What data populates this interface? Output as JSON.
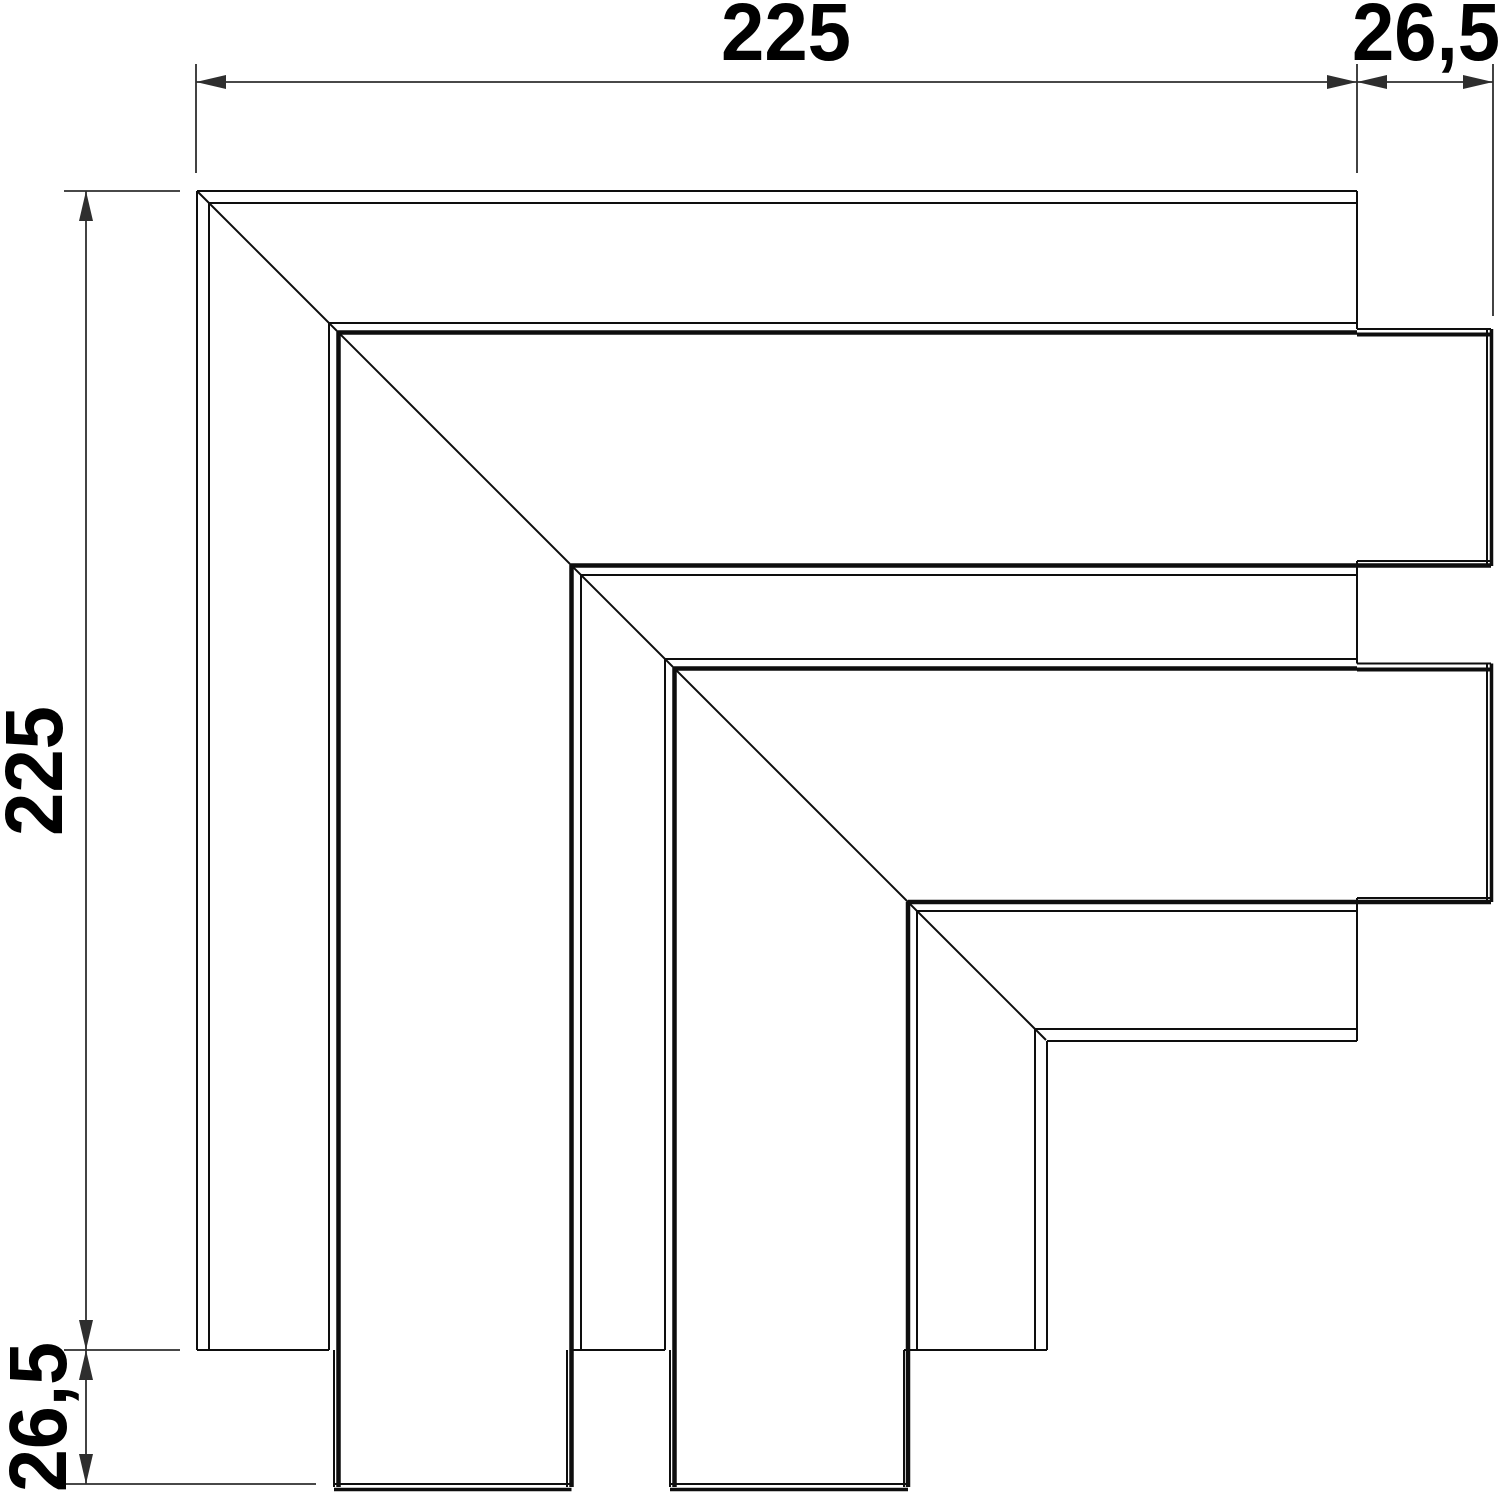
{
  "title": "Corner piece technical drawing",
  "canvas": {
    "width": 1500,
    "height": 1495,
    "background": "#ffffff",
    "line_color": "#0e0e0e",
    "dim_color": "#2e2e2e",
    "text_color": "#000000",
    "font_size": 82
  },
  "dimensions": {
    "top_width": {
      "label": "225"
    },
    "top_tail": {
      "label": "26,5"
    },
    "left_height": {
      "label": "225"
    },
    "bottom_tail": {
      "label": "26,5"
    }
  },
  "drawing": {
    "segments": [
      {
        "x1": 197,
        "y1": 191,
        "x2": 1046,
        "y2": 1040,
        "w": 2
      },
      {
        "x1": 197,
        "y1": 191,
        "x2": 1357,
        "y2": 191,
        "w": 2
      },
      {
        "x1": 209,
        "y1": 203,
        "x2": 1357,
        "y2": 203,
        "w": 2
      },
      {
        "x1": 329,
        "y1": 323,
        "x2": 1357,
        "y2": 323,
        "w": 2
      },
      {
        "x1": 338,
        "y1": 332.5,
        "x2": 1357,
        "y2": 332.5,
        "w": 4.5
      },
      {
        "x1": 1357,
        "y1": 329,
        "x2": 1491,
        "y2": 329,
        "w": 2
      },
      {
        "x1": 1357,
        "y1": 334.5,
        "x2": 1491,
        "y2": 334.5,
        "w": 4
      },
      {
        "x1": 1357,
        "y1": 561,
        "x2": 1491,
        "y2": 561,
        "w": 2
      },
      {
        "x1": 571,
        "y1": 565.5,
        "x2": 1491,
        "y2": 565.5,
        "w": 4.5
      },
      {
        "x1": 581,
        "y1": 575,
        "x2": 1357,
        "y2": 575,
        "w": 2
      },
      {
        "x1": 665,
        "y1": 659,
        "x2": 1357,
        "y2": 659,
        "w": 2
      },
      {
        "x1": 674,
        "y1": 668.5,
        "x2": 1357,
        "y2": 668.5,
        "w": 4.5
      },
      {
        "x1": 1357,
        "y1": 663.5,
        "x2": 1491,
        "y2": 663.5,
        "w": 2
      },
      {
        "x1": 1357,
        "y1": 669.5,
        "x2": 1491,
        "y2": 669.5,
        "w": 4
      },
      {
        "x1": 1357,
        "y1": 898,
        "x2": 1491,
        "y2": 898,
        "w": 2
      },
      {
        "x1": 908,
        "y1": 902,
        "x2": 1491,
        "y2": 902,
        "w": 4.5
      },
      {
        "x1": 917,
        "y1": 911,
        "x2": 1357,
        "y2": 911,
        "w": 2
      },
      {
        "x1": 1035,
        "y1": 1029,
        "x2": 1357,
        "y2": 1029,
        "w": 2
      },
      {
        "x1": 1047,
        "y1": 1041,
        "x2": 1357,
        "y2": 1041,
        "w": 2
      },
      {
        "x1": 197,
        "y1": 191,
        "x2": 197,
        "y2": 1350,
        "w": 2
      },
      {
        "x1": 209,
        "y1": 203,
        "x2": 209,
        "y2": 1350,
        "w": 2
      },
      {
        "x1": 329,
        "y1": 323,
        "x2": 329,
        "y2": 1350,
        "w": 2
      },
      {
        "x1": 338.5,
        "y1": 332,
        "x2": 338.5,
        "y2": 1487,
        "w": 4.5
      },
      {
        "x1": 334,
        "y1": 1350,
        "x2": 334,
        "y2": 1487,
        "w": 2
      },
      {
        "x1": 571.5,
        "y1": 565,
        "x2": 571.5,
        "y2": 1487,
        "w": 4.5
      },
      {
        "x1": 567,
        "y1": 1350,
        "x2": 567,
        "y2": 1487,
        "w": 2
      },
      {
        "x1": 581,
        "y1": 575,
        "x2": 581,
        "y2": 1350,
        "w": 2
      },
      {
        "x1": 665,
        "y1": 659,
        "x2": 665,
        "y2": 1350,
        "w": 2
      },
      {
        "x1": 674.5,
        "y1": 668,
        "x2": 674.5,
        "y2": 1487,
        "w": 4.5
      },
      {
        "x1": 670,
        "y1": 1350,
        "x2": 670,
        "y2": 1487,
        "w": 2
      },
      {
        "x1": 904,
        "y1": 1350,
        "x2": 904,
        "y2": 1487,
        "w": 2
      },
      {
        "x1": 908,
        "y1": 902,
        "x2": 908,
        "y2": 1487,
        "w": 4.5
      },
      {
        "x1": 917,
        "y1": 911,
        "x2": 917,
        "y2": 1350,
        "w": 2
      },
      {
        "x1": 1035,
        "y1": 1029,
        "x2": 1035,
        "y2": 1350,
        "w": 2
      },
      {
        "x1": 1047,
        "y1": 1041,
        "x2": 1047,
        "y2": 1350,
        "w": 2
      },
      {
        "x1": 1357,
        "y1": 191,
        "x2": 1357,
        "y2": 329,
        "w": 2
      },
      {
        "x1": 1357,
        "y1": 561,
        "x2": 1357,
        "y2": 663.5,
        "w": 2
      },
      {
        "x1": 1357,
        "y1": 898,
        "x2": 1357,
        "y2": 1041,
        "w": 2
      },
      {
        "x1": 1487,
        "y1": 329,
        "x2": 1487,
        "y2": 566,
        "w": 2
      },
      {
        "x1": 1491.5,
        "y1": 329,
        "x2": 1491.5,
        "y2": 566,
        "w": 3.5
      },
      {
        "x1": 1487,
        "y1": 663.5,
        "x2": 1487,
        "y2": 902,
        "w": 2
      },
      {
        "x1": 1491.5,
        "y1": 663.5,
        "x2": 1491.5,
        "y2": 902,
        "w": 3.5
      },
      {
        "x1": 197,
        "y1": 1350,
        "x2": 329,
        "y2": 1350,
        "w": 2
      },
      {
        "x1": 571,
        "y1": 1350,
        "x2": 665,
        "y2": 1350,
        "w": 2
      },
      {
        "x1": 904,
        "y1": 1350,
        "x2": 1047,
        "y2": 1350,
        "w": 2
      },
      {
        "x1": 334,
        "y1": 1484,
        "x2": 571.5,
        "y2": 1484,
        "w": 2
      },
      {
        "x1": 334,
        "y1": 1489.5,
        "x2": 571.5,
        "y2": 1489.5,
        "w": 3.5
      },
      {
        "x1": 670,
        "y1": 1484,
        "x2": 908,
        "y2": 1484,
        "w": 2
      },
      {
        "x1": 670,
        "y1": 1489.5,
        "x2": 908,
        "y2": 1489.5,
        "w": 3.5
      }
    ],
    "dim_lines": [
      {
        "x1": 196,
        "y1": 82,
        "x2": 1493,
        "y2": 82
      },
      {
        "x1": 86,
        "y1": 191,
        "x2": 86,
        "y2": 1484
      }
    ],
    "ext_lines": [
      {
        "x1": 196,
        "y1": 64,
        "x2": 196,
        "y2": 173
      },
      {
        "x1": 1357,
        "y1": 64,
        "x2": 1357,
        "y2": 173
      },
      {
        "x1": 1493,
        "y1": 64,
        "x2": 1493,
        "y2": 316
      },
      {
        "x1": 64,
        "y1": 191,
        "x2": 180,
        "y2": 191
      },
      {
        "x1": 64,
        "y1": 1350,
        "x2": 180,
        "y2": 1350
      },
      {
        "x1": 64,
        "y1": 1484,
        "x2": 316,
        "y2": 1484
      }
    ],
    "arrows": [
      {
        "x": 196,
        "y": 82,
        "dir": "left"
      },
      {
        "x": 1357,
        "y": 82,
        "dir": "right"
      },
      {
        "x": 1357,
        "y": 82,
        "dir": "left"
      },
      {
        "x": 1493,
        "y": 82,
        "dir": "right"
      },
      {
        "x": 86,
        "y": 191,
        "dir": "up"
      },
      {
        "x": 86,
        "y": 1350,
        "dir": "down"
      },
      {
        "x": 86,
        "y": 1350,
        "dir": "up"
      },
      {
        "x": 86,
        "y": 1484,
        "dir": "down"
      }
    ],
    "texts": [
      {
        "label": "225",
        "x": 786,
        "y": 60,
        "rot": 0,
        "len": 130
      },
      {
        "label": "26,5",
        "x": 1426,
        "y": 60,
        "rot": 0,
        "len": 148
      },
      {
        "label": "225",
        "x": 62,
        "y": 771,
        "rot": -90,
        "len": 130
      },
      {
        "label": "26,5",
        "x": 66,
        "y": 1417,
        "rot": -90,
        "len": 150
      }
    ]
  }
}
